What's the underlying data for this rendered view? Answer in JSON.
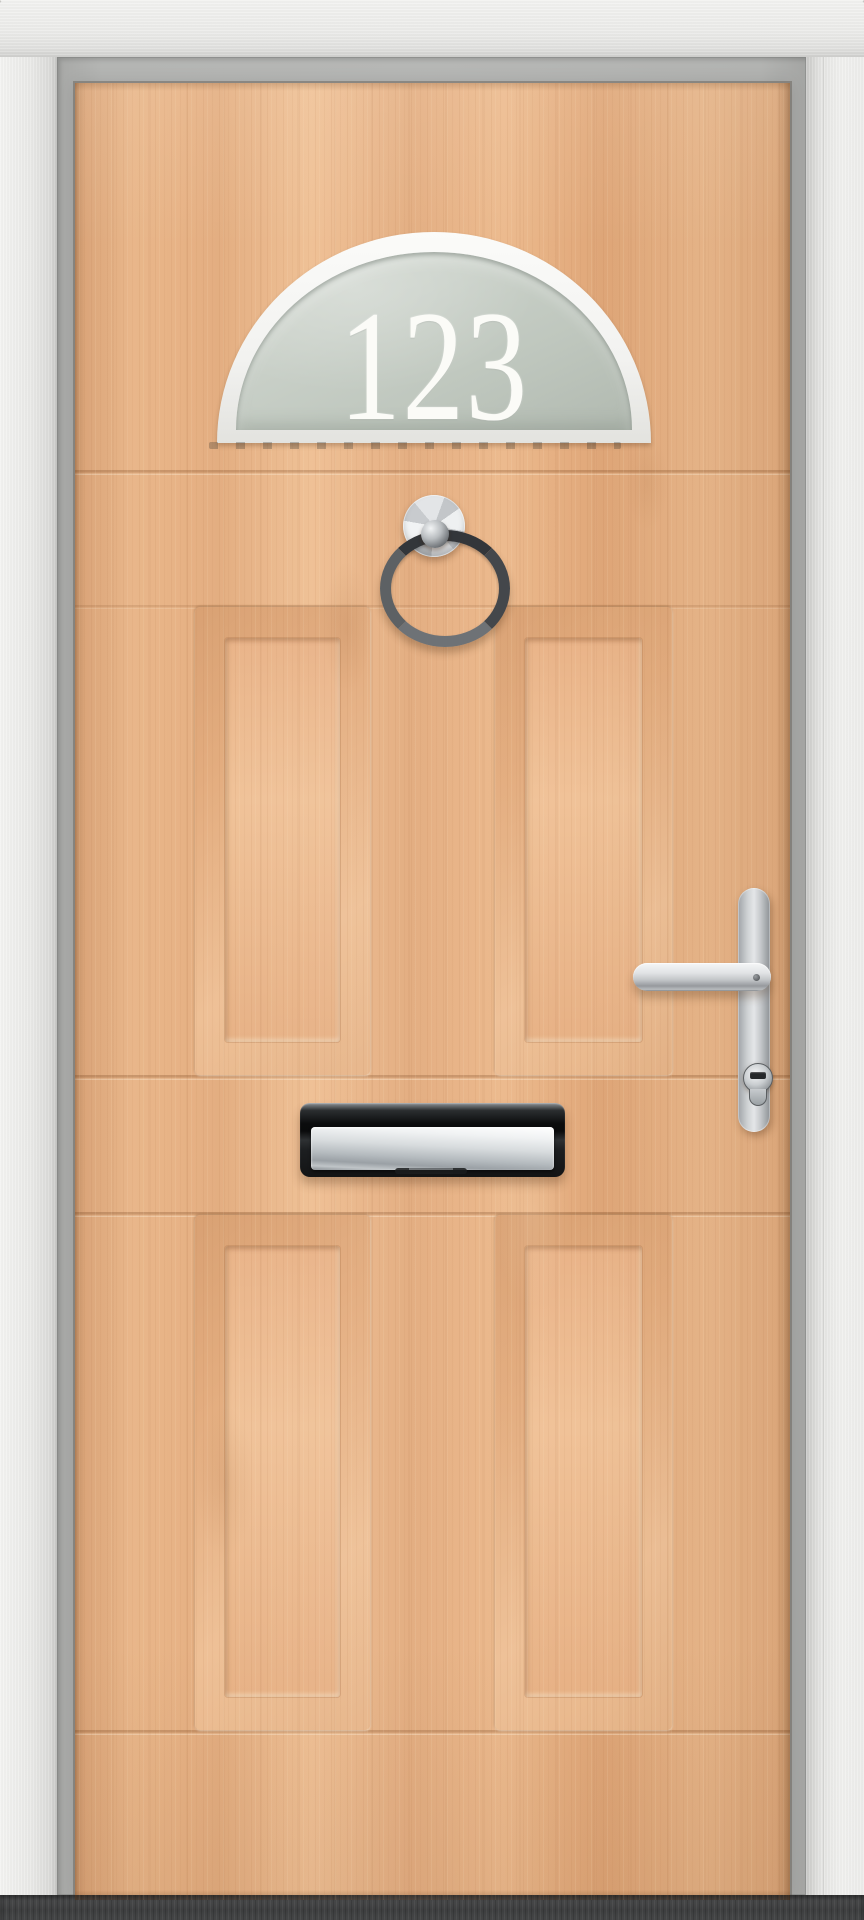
{
  "window": {
    "glass_number": "123"
  },
  "hardware": {
    "knocker": "chrome-ring-knocker",
    "handle": "chrome-lever-handle",
    "lock": "euro-cylinder-lock",
    "letterplate": "chrome-letter-plate"
  },
  "colors": {
    "wood_base": "#e6b185",
    "wood_shadow": "#d49a6c",
    "wood_highlight": "#f3c89e",
    "frame_white": "#e9e9e7",
    "frame_rebate": "#b3b4b2",
    "glass": "#c6cdc5",
    "glass_number_white": "#fbfbf7",
    "chrome_bright": "#eff1f2",
    "chrome_mid": "#b9bdc0",
    "chrome_dark": "#3a3d40",
    "letterplate_black": "#101112",
    "threshold": "#434445"
  }
}
